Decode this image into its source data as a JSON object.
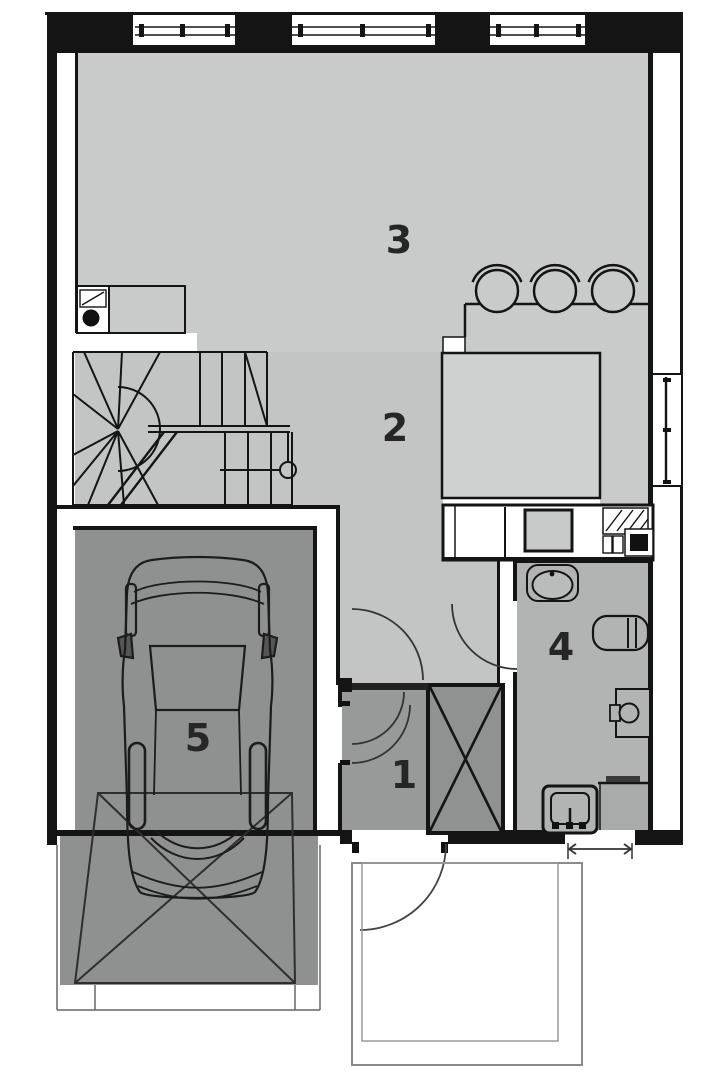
{
  "plan": {
    "title": "house-ground-floor-plan",
    "room_labels": [
      {
        "number": "1",
        "name": "entry-hall"
      },
      {
        "number": "2",
        "name": "hall"
      },
      {
        "number": "3",
        "name": "living-room-kitchen"
      },
      {
        "number": "4",
        "name": "bathroom"
      },
      {
        "number": "5",
        "name": "garage"
      }
    ],
    "fixtures": [
      "staircase",
      "car",
      "kitchen-counter",
      "cooktop",
      "kitchen-sink",
      "bar-stools",
      "kitchen-island",
      "washbasin",
      "radiator",
      "toilet",
      "washing-machine",
      "wardrobe",
      "entrance-door",
      "garage-door-area",
      "porch",
      "windows",
      "door-arcs"
    ],
    "colors": {
      "room_light": "#c9cbca",
      "hall": "#c3c5c4",
      "kitchen_zone": "#cfd1d0",
      "bathroom": "#b2b4b3",
      "entry": "#979a99",
      "wardrobe_fill": "#8f9291",
      "garage": "#8e9190",
      "wall": "#141414"
    }
  }
}
